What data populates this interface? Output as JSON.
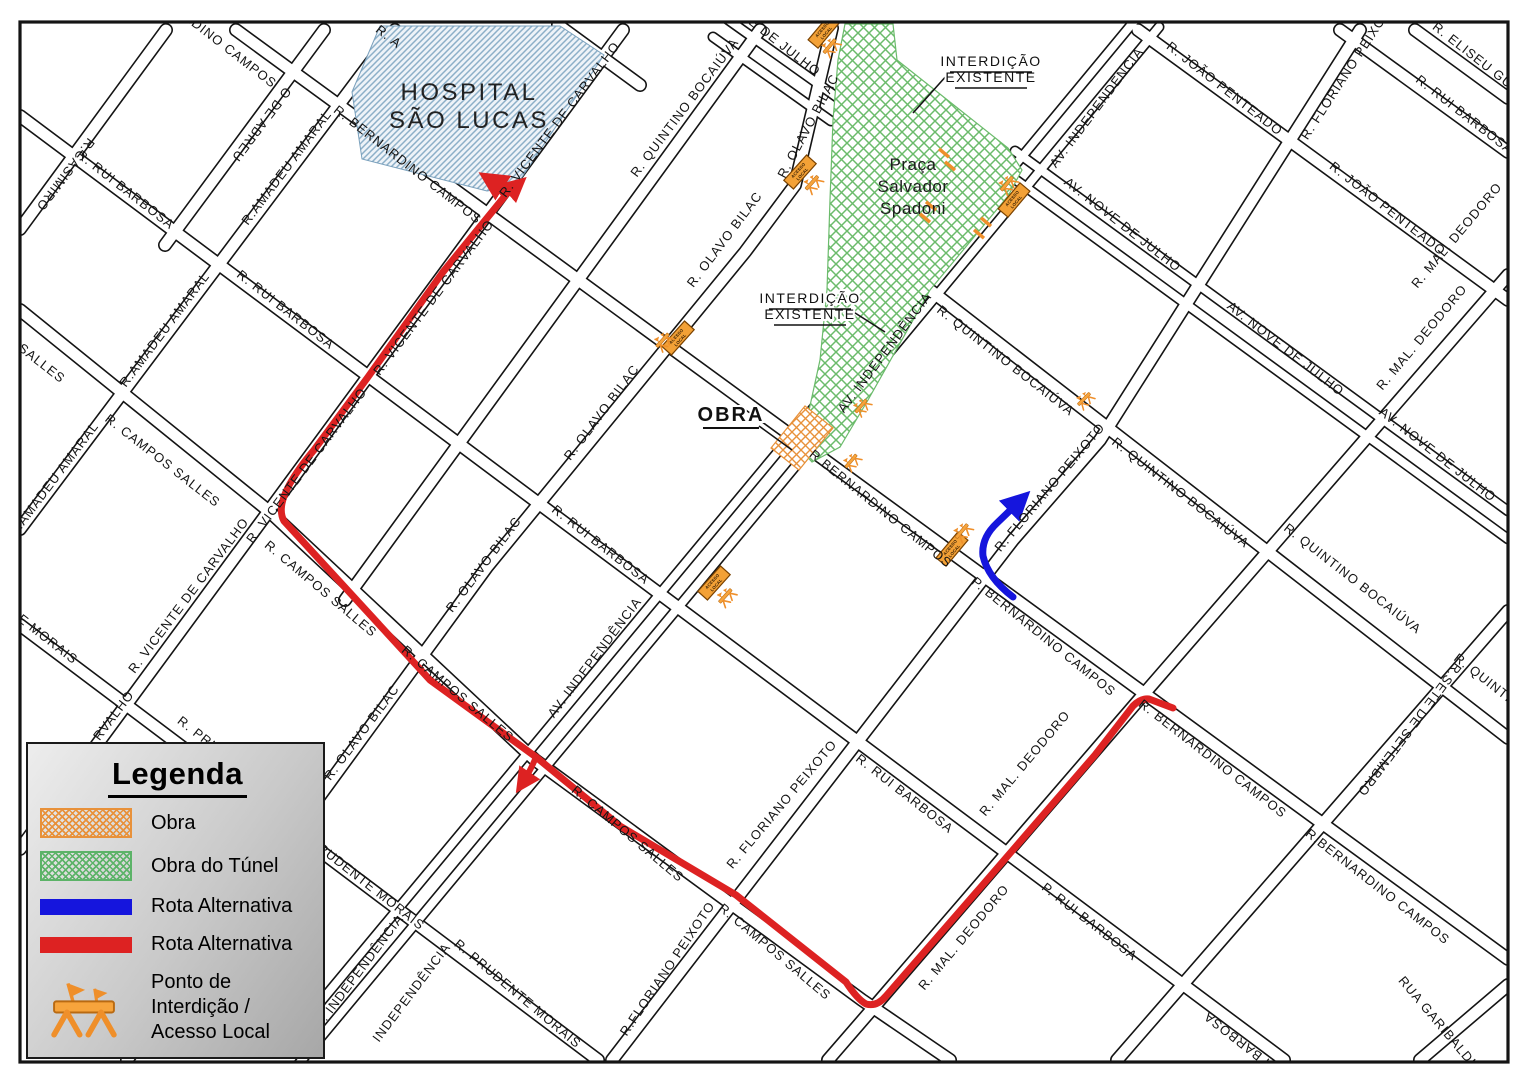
{
  "legend": {
    "title": "Legenda",
    "items": [
      {
        "key": "obra",
        "label": "Obra",
        "style": "hatch",
        "color": "#e8913a"
      },
      {
        "key": "obra-tunel",
        "label": "Obra do Túnel",
        "style": "hatch",
        "color": "#5cb368"
      },
      {
        "key": "rota-alternativa-azul",
        "label": "Rota Alternativa",
        "style": "bar",
        "color": "#1515dd"
      },
      {
        "key": "rota-alternativa-vermelha",
        "label": "Rota Alternativa",
        "style": "bar",
        "color": "#dd2222"
      },
      {
        "key": "ponto-interdicao",
        "label_line1": "Ponto de Interdição /",
        "label_line2": "Acesso Local",
        "style": "icon",
        "color": "#ef8f2a"
      }
    ]
  },
  "map": {
    "hospital": {
      "name_lines": [
        "HOSPITAL",
        "SÃO LUCAS"
      ],
      "label_x": 469,
      "label_y": 100,
      "points": "380,26 560,26 604,55 516,186 487,191 362,159 352,92"
    },
    "praca": {
      "name_lines": [
        "Praça",
        "Salvador",
        "Spadoni"
      ],
      "label_x": 913,
      "label_y": 170,
      "points": "845,24 893,24 897,60 1008,148 1022,170 1008,196 930,290 868,400 840,447 812,462 797,446 808,415 820,360 827,290 830,200 833,120 838,60"
    },
    "obra_area": {
      "points": "805,406 833,428 799,470 771,448"
    },
    "annotations": {
      "obra": {
        "text": "OBRA",
        "x": 731,
        "y": 421,
        "underline": [
          703,
          428,
          759,
          428
        ],
        "leader": [
          759,
          426,
          792,
          450
        ]
      },
      "interdicao_1": {
        "line1": "INTERDIÇÃO",
        "line2": "EXISTENTE",
        "x": 991,
        "y": 66,
        "ul1": [
          950,
          72,
          1032,
          72
        ],
        "ul2": [
          955,
          88,
          1027,
          88
        ],
        "leader": [
          948,
          74,
          913,
          113
        ]
      },
      "interdicao_2": {
        "line1": "INTERDIÇÃO",
        "line2": "EXISTENTE",
        "x": 810,
        "y": 303,
        "ul1": [
          769,
          309,
          851,
          309
        ],
        "ul2": [
          774,
          325,
          846,
          325
        ],
        "leader": [
          852,
          311,
          885,
          332
        ]
      }
    },
    "routes": {
      "red": {
        "color": "#dd2222",
        "main": "M486,177 Q500,186 505,196 L443,272 368,377 314,450 Q272,500 284,521 L430,680 536,757 620,826 736,895 846,982 Q857,999 866,1004 Q877,1007 886,996 L980,888 1095,755 1133,706 Q1141,698 1149,699 L1173,708",
        "stub": "M505,196 Q513,189 521,182",
        "branch": "M536,757 Q530,772 520,787"
      },
      "blue": {
        "color": "#1515dd",
        "path": "M1013,597 Q988,578 983,556 Q981,538 997,523 L1024,497"
      }
    },
    "barriers": {
      "sign_line1": "ACESSO",
      "sign_line2": "LOCAL",
      "points": [
        {
          "x": 824,
          "y": 31,
          "rot": -50,
          "sign": true,
          "sx": -8,
          "sy": 14
        },
        {
          "x": 800,
          "y": 172,
          "rot": -48,
          "sign": true,
          "sx": 0,
          "sy": 16
        },
        {
          "x": 1014,
          "y": 200,
          "rot": -50,
          "sign": true,
          "sx": 8,
          "sy": -16
        },
        {
          "x": 678,
          "y": 338,
          "rot": -48,
          "sign": true,
          "sx": -12,
          "sy": -10
        },
        {
          "x": 861,
          "y": 406,
          "rot": -50,
          "sign": false,
          "sx": 0,
          "sy": 0
        },
        {
          "x": 851,
          "y": 461,
          "rot": -50,
          "sign": false,
          "sx": 0,
          "sy": 0
        },
        {
          "x": 952,
          "y": 549,
          "rot": -50,
          "sign": true,
          "sx": 20,
          "sy": -4
        },
        {
          "x": 1084,
          "y": 399,
          "rot": -45,
          "sign": false,
          "sx": 0,
          "sy": 0
        },
        {
          "x": 714,
          "y": 583,
          "rot": -48,
          "sign": true,
          "sx": -2,
          "sy": 17
        }
      ]
    },
    "ticks": [
      [
        944,
        153
      ],
      [
        950,
        166
      ],
      [
        931,
        206
      ],
      [
        925,
        218
      ],
      [
        986,
        222
      ],
      [
        979,
        234
      ]
    ],
    "street_labels": [
      {
        "t": "R.CASIMIRO",
        "x": 62,
        "y": 172,
        "r": 127
      },
      {
        "t": "O DE ABREU",
        "x": 258,
        "y": 122,
        "r": 127
      },
      {
        "t": "R.AMADEU AMARAL",
        "x": 290,
        "y": 170,
        "r": -53
      },
      {
        "t": "R.AMADEU AMARAL",
        "x": 168,
        "y": 332,
        "r": -53
      },
      {
        "t": "R.AMADEU AMARAL",
        "x": 57,
        "y": 482,
        "r": -53
      },
      {
        "t": "R. VICENTE DE CARVALHO",
        "x": 563,
        "y": 122,
        "r": -53
      },
      {
        "t": "R. VICENTE DE CARVALHO",
        "x": 437,
        "y": 300,
        "r": -53
      },
      {
        "t": "R. VICENTE DE CARVALHO",
        "x": 310,
        "y": 468,
        "r": -53
      },
      {
        "t": "R. VICENTE DE CARVALHO",
        "x": 192,
        "y": 598,
        "r": -53
      },
      {
        "t": "RVALHO",
        "x": 117,
        "y": 718,
        "r": -53
      },
      {
        "t": "R. QUINTINO BOCAIÚVA",
        "x": 688,
        "y": 110,
        "r": -53
      },
      {
        "t": "R. OLAVO BILAC",
        "x": 812,
        "y": 128,
        "r": -62
      },
      {
        "t": "R. OLAVO BILAC",
        "x": 728,
        "y": 242,
        "r": -53
      },
      {
        "t": "R. OLAVO BILAC",
        "x": 605,
        "y": 415,
        "r": -53
      },
      {
        "t": "R. OLAVO BILAC",
        "x": 487,
        "y": 567,
        "r": -53
      },
      {
        "t": "R. OLAVO BILAC",
        "x": 365,
        "y": 735,
        "r": -53
      },
      {
        "t": "AV. INDEPENDÊNCIA",
        "x": 1100,
        "y": 110,
        "r": -53
      },
      {
        "t": "AV. INDEPENDÊNCIA",
        "x": 888,
        "y": 355,
        "r": -53
      },
      {
        "t": "AV. INDEPENDÊNCIA",
        "x": 598,
        "y": 660,
        "r": -53
      },
      {
        "t": "AV. INDEPENDÊNCIA",
        "x": 360,
        "y": 977,
        "r": -53
      },
      {
        "t": "INDEPENDÊNCIA",
        "x": 415,
        "y": 995,
        "r": -53
      },
      {
        "t": "R. FLORIANO PEIXOTO",
        "x": 1352,
        "y": 72,
        "r": -57
      },
      {
        "t": "R. FLORIANO PEIXOTO",
        "x": 1053,
        "y": 490,
        "r": -50
      },
      {
        "t": "R. FLORIANO PEIXOTO",
        "x": 785,
        "y": 807,
        "r": -50
      },
      {
        "t": "R.FLORIANO PEIXOTO",
        "x": 671,
        "y": 971,
        "r": -56
      },
      {
        "t": "R. MAL. DEODORO",
        "x": 1460,
        "y": 238,
        "r": -50
      },
      {
        "t": "R. MAL. DEODORO",
        "x": 1425,
        "y": 340,
        "r": -50
      },
      {
        "t": "R. MAL. DEODORO",
        "x": 1028,
        "y": 766,
        "r": -50
      },
      {
        "t": "R. MAL. DEODORO",
        "x": 967,
        "y": 940,
        "r": -50
      },
      {
        "t": "R.SETE DE SETEMBRO",
        "x": 1406,
        "y": 727,
        "r": 127
      },
      {
        "t": "RUA GARIBALDI",
        "x": 1434,
        "y": 1024,
        "r": 50
      },
      {
        "t": "R. BERNARDINO CAMPOS",
        "x": 200,
        "y": 32,
        "r": 38
      },
      {
        "t": "R. BERNARDINO CAMPOS",
        "x": 405,
        "y": 168,
        "r": 38
      },
      {
        "t": "R.BERNARDINO CAMPOS",
        "x": 878,
        "y": 512,
        "r": 39
      },
      {
        "t": "P. BERNARDINO CAMPOS",
        "x": 1041,
        "y": 640,
        "r": 39
      },
      {
        "t": "R. BERNARDINO CAMPOS",
        "x": 1210,
        "y": 762,
        "r": 38
      },
      {
        "t": "R.BERNARDINO CAMPOS",
        "x": 1375,
        "y": 890,
        "r": 38
      },
      {
        "t": "R. RUI BARBOSA",
        "x": 123,
        "y": 193,
        "r": 38
      },
      {
        "t": "R. RUI BARBOSA",
        "x": 283,
        "y": 313,
        "r": 38
      },
      {
        "t": "R. RUI BARBOSA",
        "x": 598,
        "y": 548,
        "r": 38
      },
      {
        "t": "R. RUI BARBOSA",
        "x": 902,
        "y": 797,
        "r": 38
      },
      {
        "t": "P. RUI BARBOSA",
        "x": 1087,
        "y": 925,
        "r": 38
      },
      {
        "t": "R. RUI BARBOSA",
        "x": 1255,
        "y": 1048,
        "r": 218
      },
      {
        "t": "R. CAMPOS SALLES",
        "x": 5,
        "y": 340,
        "r": 38
      },
      {
        "t": "R. CAMPOS SALLES",
        "x": 160,
        "y": 464,
        "r": 38
      },
      {
        "t": "R. CAMPOS SALLES",
        "x": 318,
        "y": 592,
        "r": 40
      },
      {
        "t": "R. CAMPOS SALLES",
        "x": 455,
        "y": 697,
        "r": 40
      },
      {
        "t": "R. CAMPOS SALLES",
        "x": 625,
        "y": 837,
        "r": 40
      },
      {
        "t": "R. CAMPOS SALLES",
        "x": 772,
        "y": 955,
        "r": 40
      },
      {
        "t": "R. PRUDENTE MORAIS",
        "x": 10,
        "y": 615,
        "r": 38
      },
      {
        "t": "R. PRUDENTE MORAIS",
        "x": 357,
        "y": 881,
        "r": 38
      },
      {
        "t": "R. PRUDENTE MORAIS",
        "x": 515,
        "y": 997,
        "r": 40
      },
      {
        "t": "R. PRUDENTE MORAIS",
        "x": 240,
        "y": 772,
        "r": 38
      },
      {
        "t": "R. JOÃO PENTEADO",
        "x": 1222,
        "y": 92,
        "r": 38
      },
      {
        "t": "R. JOÃO PENTEADO",
        "x": 1385,
        "y": 212,
        "r": 38
      },
      {
        "t": "R. ELISEU GUI",
        "x": 1472,
        "y": 60,
        "r": 38
      },
      {
        "t": "R. RUI BARBOSA",
        "x": 1462,
        "y": 118,
        "r": 38
      },
      {
        "t": "E DE JULHO",
        "x": 782,
        "y": 50,
        "r": 38
      },
      {
        "t": "AV. NOVE DE JULHO",
        "x": 1120,
        "y": 228,
        "r": 38
      },
      {
        "t": "AV. NOVE DE JULHO",
        "x": 1283,
        "y": 352,
        "r": 38
      },
      {
        "t": "AV. NOVE DE JULHO",
        "x": 1435,
        "y": 458,
        "r": 38
      },
      {
        "t": "R. QUINTINO BOCAIÚVA",
        "x": 1003,
        "y": 364,
        "r": 38
      },
      {
        "t": "R. QUINTINO BOCAIÚVA",
        "x": 1178,
        "y": 496,
        "r": 38
      },
      {
        "t": "R. QUINTINO BOCAIÚVA",
        "x": 1350,
        "y": 582,
        "r": 38
      },
      {
        "t": "R. QUINTINO BOCAIÚVA",
        "x": 1520,
        "y": 712,
        "r": 38
      },
      {
        "t": "R. A",
        "x": 386,
        "y": 40,
        "r": 38
      }
    ]
  }
}
